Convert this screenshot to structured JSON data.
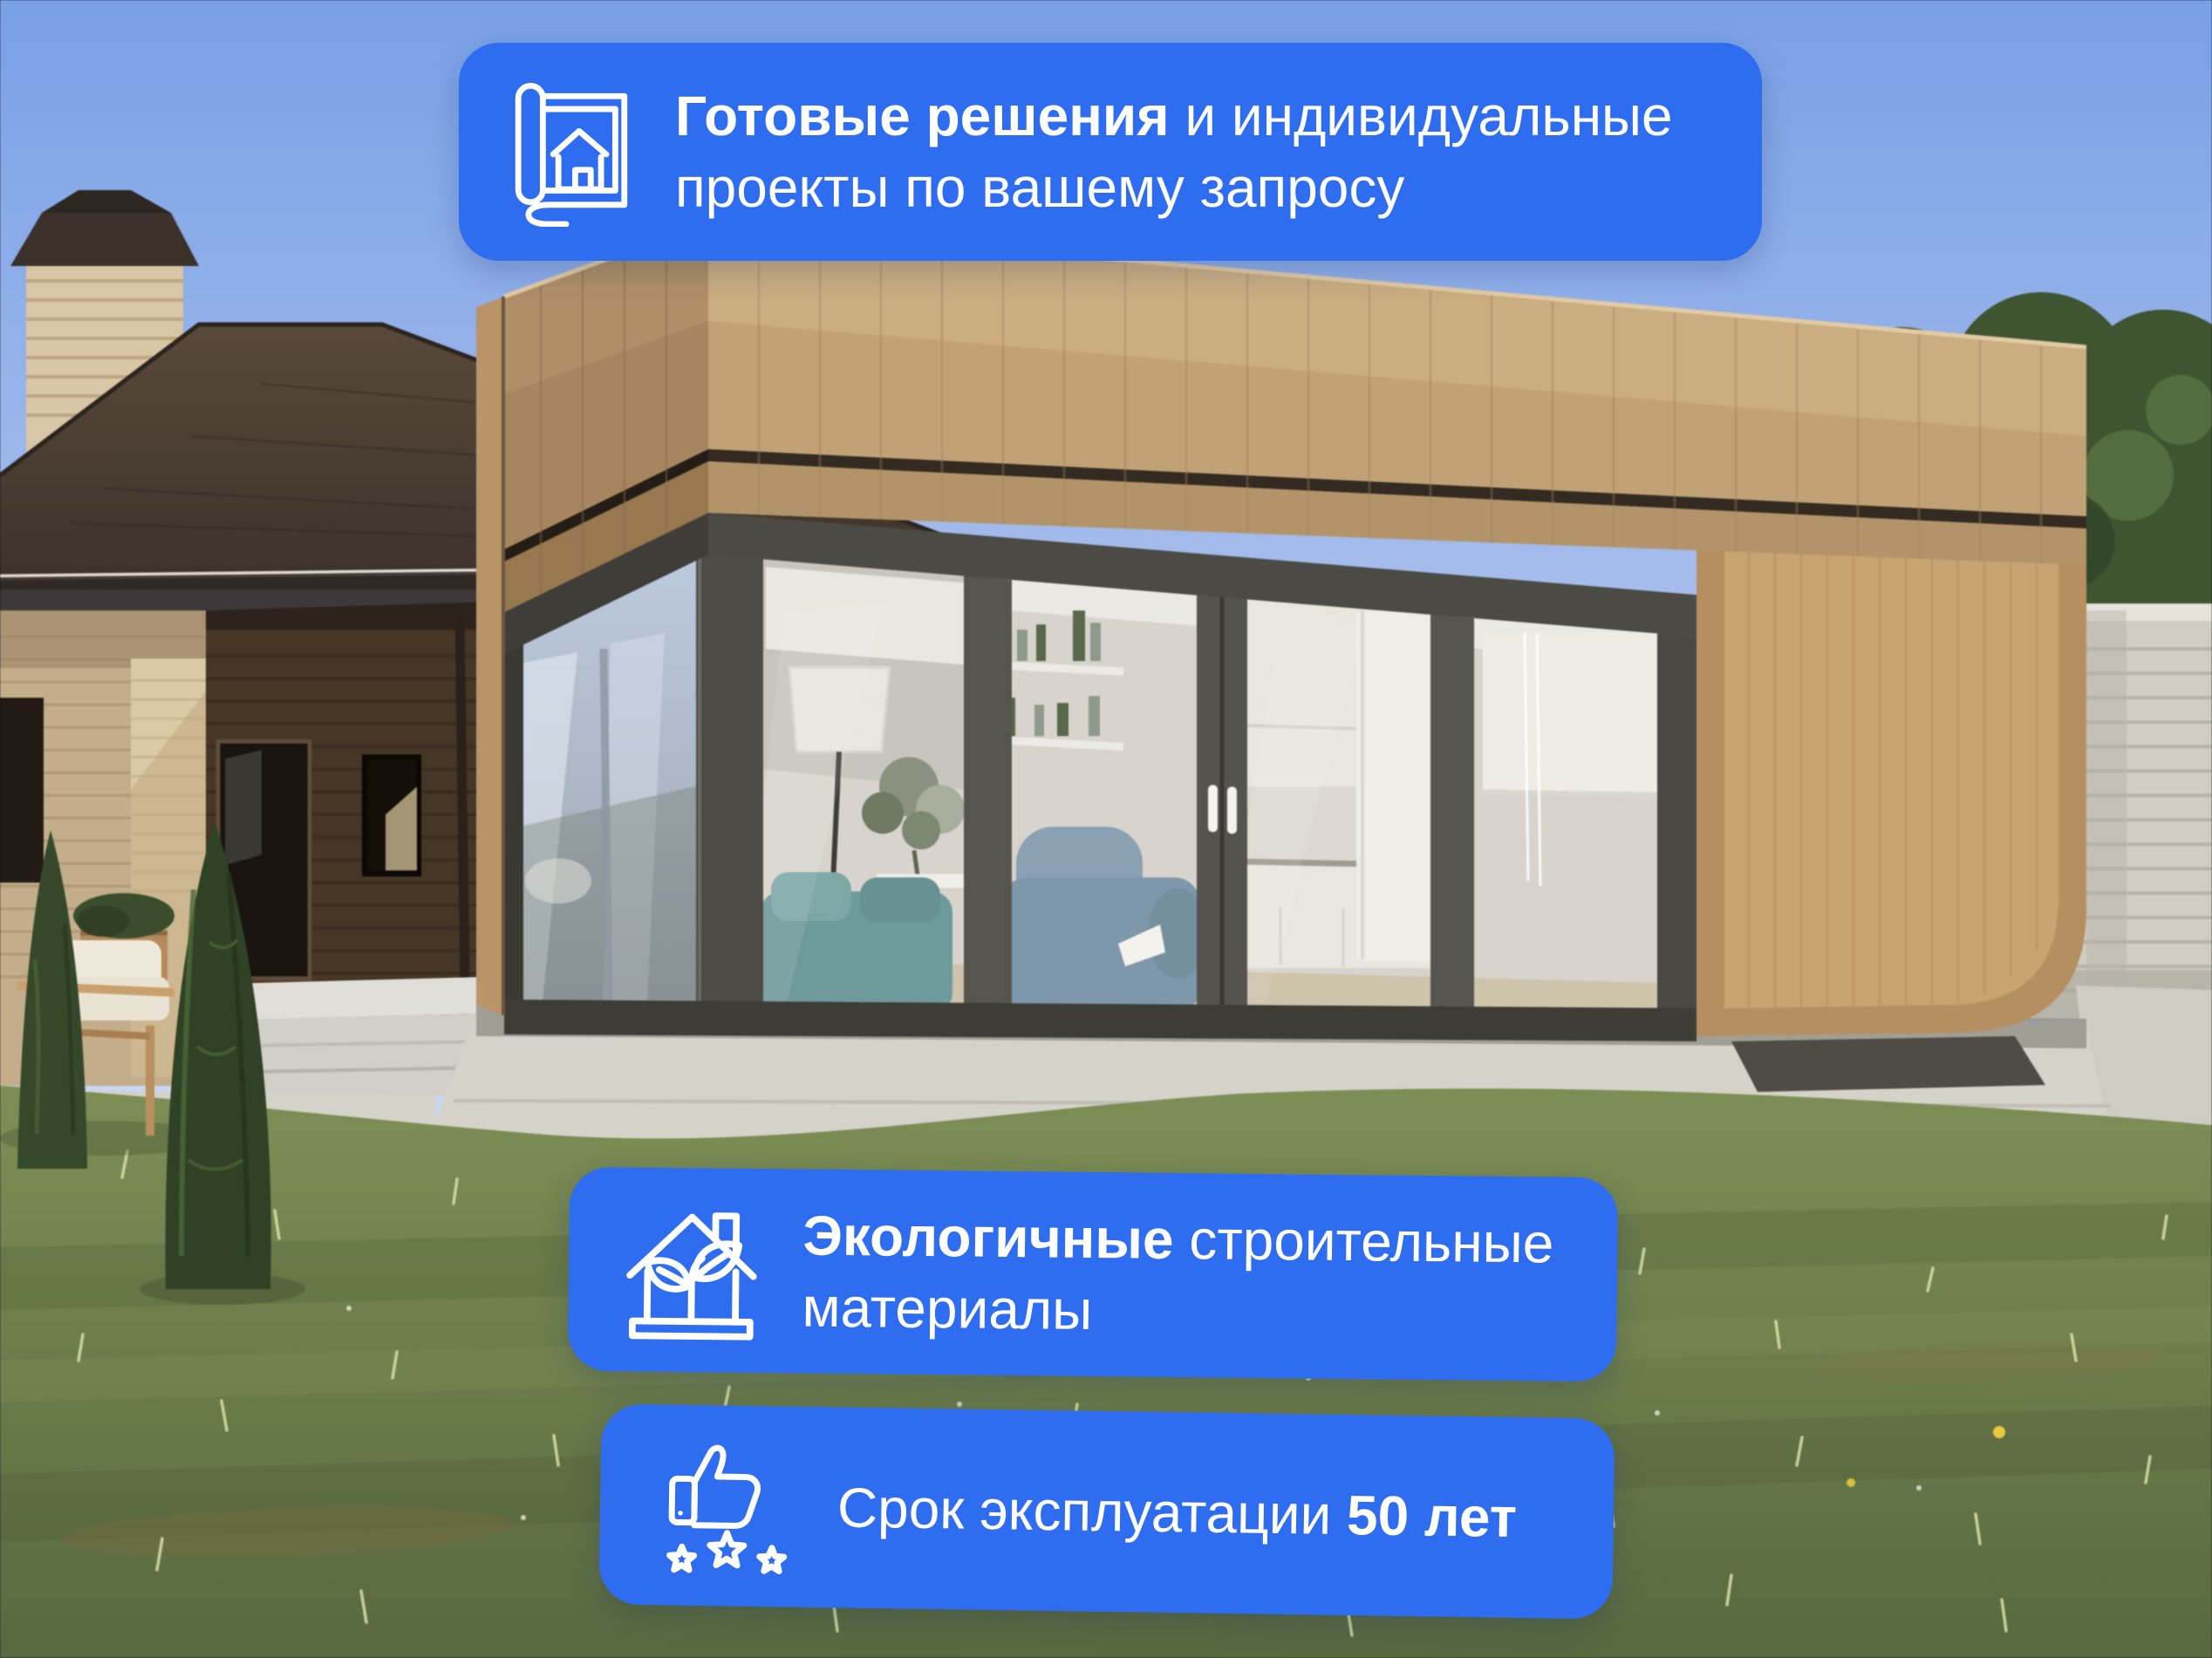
{
  "badges": {
    "ready": {
      "icon": "blueprint-house-icon",
      "line1_bold": "Готовые решения",
      "line1_rest": " и индивидуальные",
      "line2": "проекты по вашему запросу"
    },
    "eco": {
      "icon": "eco-house-sprout-icon",
      "line1_bold": "Экологичные",
      "line1_rest": " строительные",
      "line2": "материалы"
    },
    "lifespan": {
      "icon": "thumbs-up-stars-icon",
      "text": "Срок эксплуатации",
      "value_bold": "50 лет"
    }
  },
  "colors": {
    "badge_background": "#2e6cf0",
    "badge_text": "#ffffff"
  },
  "scene_palette": {
    "sky": "#7ba1e6",
    "sky_horizon": "#ccd9f0",
    "lawn_green": "#6f8050",
    "cabin_wood": "#c1a274",
    "roof_brown": "#46382e",
    "fence_gray": "#d0ccc1",
    "foliage_green": "#3f5531",
    "concrete": "#d5d2ca",
    "interior_white": "#d8d4cd",
    "glass_reflection": "#b9c8de"
  }
}
